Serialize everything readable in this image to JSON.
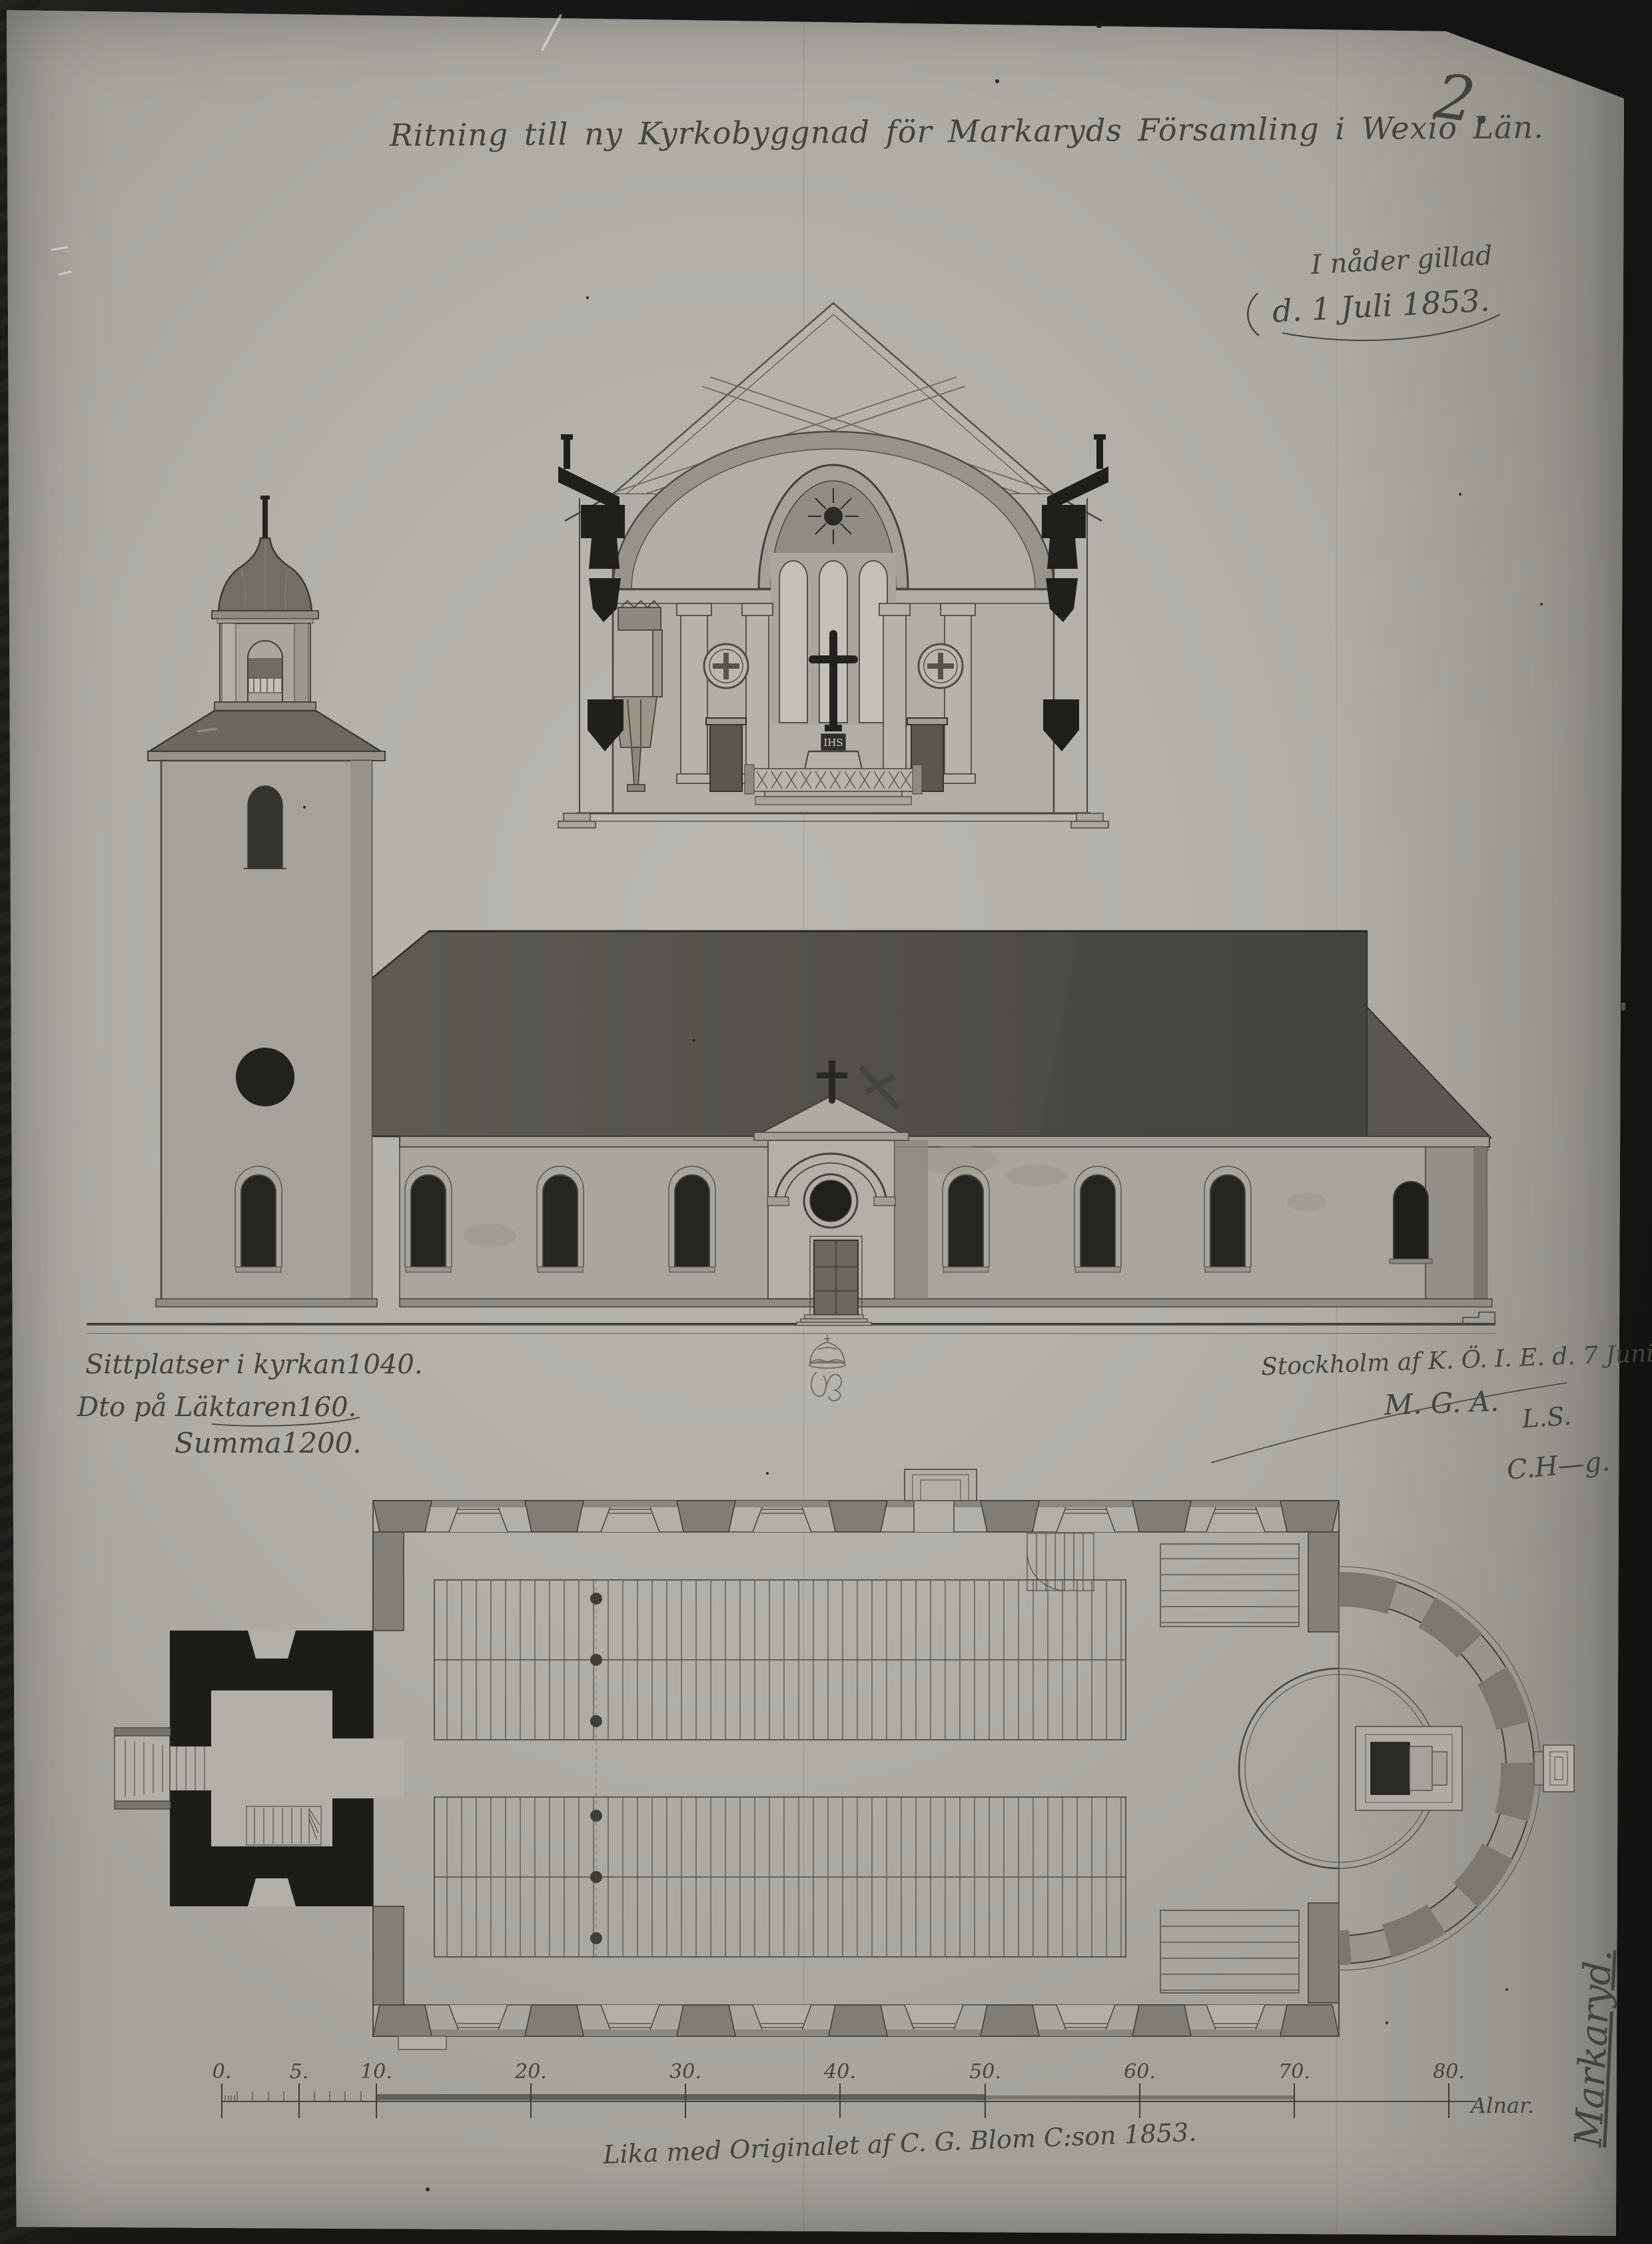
{
  "photo": {
    "background_color": "#161614",
    "paper_color": "#b2afa9",
    "ink_color": "#43423c"
  },
  "page": {
    "number": "2."
  },
  "header": {
    "title": "Ritning till ny Kyrkobyggnad för Markaryds Församling i Wexiö Län."
  },
  "approval": {
    "line1": "I nåder gillad",
    "line2": "d. 1 Juli 1853."
  },
  "seating": {
    "rows": [
      {
        "label": "Sittplatser i kyrkan",
        "value": "1040."
      },
      {
        "label": "Dto på Läktaren",
        "value": "160."
      }
    ],
    "total_label": "Summa",
    "total_value": "1200."
  },
  "issuance": {
    "line1": "Stockholm af K. Ö. I. E. d. 7 Juni 1853.",
    "line2": "M. G. A.",
    "signature_initials": "L.S.",
    "signature2": "C.H—g."
  },
  "certification": {
    "text": "Lika med Originalet af C. G. Blom C:son 1853."
  },
  "margin": {
    "text": "Markaryd."
  },
  "section_drawing": {
    "altar_inscription": "IHS"
  },
  "scale_bar": {
    "labels": [
      "0.",
      "5.",
      "10.",
      "20.",
      "30.",
      "40.",
      "50.",
      "60.",
      "70.",
      "80."
    ],
    "unit": "Alnar."
  }
}
